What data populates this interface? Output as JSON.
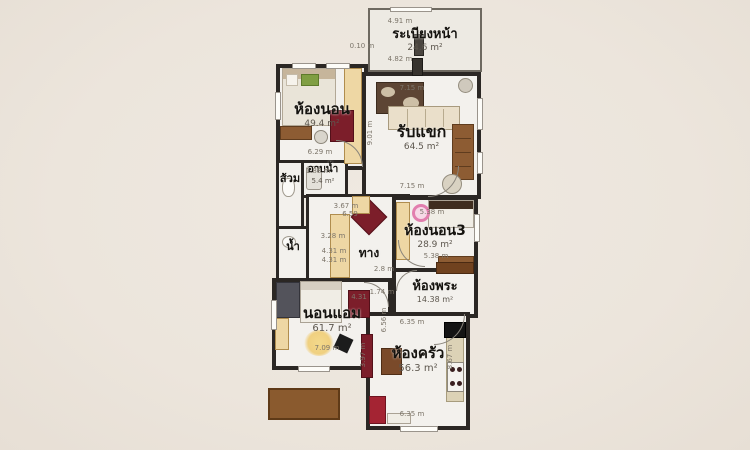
{
  "colors": {
    "background": "#ece5dc",
    "wall": "#2b2724",
    "floor": "#f3f1ed",
    "rug_red": "#7c1e2a",
    "wood": "#8d5c33",
    "closet_tan": "#eed7a4",
    "pillow_green": "#7f9e42",
    "fan_pink": "#e27fae",
    "kitchen_red": "#a42433"
  },
  "rooms": {
    "balcony": {
      "label": "ระเบียงหน้า",
      "area": "24.6 m²"
    },
    "bedroom1": {
      "label": "ห้องนอน",
      "area": "49.4 m²"
    },
    "living": {
      "label": "รับแขก",
      "area": "64.5 m²"
    },
    "shower": {
      "label": "อาบน้ำ",
      "area": "5.4 m²"
    },
    "toilet": {
      "label": "ส้วม"
    },
    "water": {
      "label": "น้ำ"
    },
    "passage": {
      "label": "ทาง"
    },
    "bedroom3": {
      "label": "ห้องนอน3",
      "area": "28.9 m²"
    },
    "prayer": {
      "label": "ห้องพระ",
      "area": "14.38 m²"
    },
    "am": {
      "label": "นอนแอม",
      "area": "61.7 m²"
    },
    "kitchen": {
      "label": "ห้องครัว",
      "area": "56.3 m²"
    }
  },
  "dim_labels": [
    {
      "t": "4.91 m",
      "x": 400,
      "y": 21
    },
    {
      "t": "0.10 m",
      "x": 362,
      "y": 46
    },
    {
      "t": "4.82 m",
      "x": 400,
      "y": 59
    },
    {
      "t": "6.29 m",
      "x": 320,
      "y": 152
    },
    {
      "t": "7.15 m",
      "x": 412,
      "y": 88
    },
    {
      "t": "9.01 m",
      "x": 370,
      "y": 133,
      "r": 1
    },
    {
      "t": "7.15 m",
      "x": 412,
      "y": 186
    },
    {
      "t": "1.88 m",
      "x": 318,
      "y": 171
    },
    {
      "t": "3.67 m",
      "x": 346,
      "y": 206
    },
    {
      "t": "6.59",
      "x": 350,
      "y": 214
    },
    {
      "t": "3.28 m",
      "x": 333,
      "y": 236
    },
    {
      "t": "4.31 m",
      "x": 334,
      "y": 251
    },
    {
      "t": "4.31 m",
      "x": 334,
      "y": 260
    },
    {
      "t": "2.8 m",
      "x": 384,
      "y": 269
    },
    {
      "t": "5.38 m",
      "x": 432,
      "y": 212
    },
    {
      "t": "5.38 m",
      "x": 436,
      "y": 256
    },
    {
      "t": "1.74 m",
      "x": 382,
      "y": 292
    },
    {
      "t": "4.31",
      "x": 359,
      "y": 297
    },
    {
      "t": "6.35 m",
      "x": 412,
      "y": 322
    },
    {
      "t": "6.35 m",
      "x": 412,
      "y": 414
    },
    {
      "t": "8.67 m",
      "x": 450,
      "y": 357,
      "r": 1
    },
    {
      "t": "3.97 m",
      "x": 363,
      "y": 355,
      "r": 1
    },
    {
      "t": "6.56 m",
      "x": 384,
      "y": 320,
      "r": 1
    },
    {
      "t": "7.09 m",
      "x": 327,
      "y": 348
    }
  ],
  "objects": [
    "double-bed",
    "wardrobe",
    "red-rug",
    "desk",
    "office-chair",
    "patterned-rug",
    "sofa",
    "bookshelf",
    "round-table",
    "side-table",
    "entry-door",
    "bench",
    "toilet-seat",
    "shower-tray",
    "basin",
    "hall-bench",
    "closet",
    "single-bed",
    "ceiling-fan",
    "dresser",
    "prayer-cabinet",
    "bed",
    "yellow-round-rug",
    "speaker",
    "kitchen-counter",
    "stove-hood",
    "cooktop-burners",
    "red-cabinet",
    "dining-set",
    "red-bench",
    "small-table",
    "outdoor-desk"
  ]
}
